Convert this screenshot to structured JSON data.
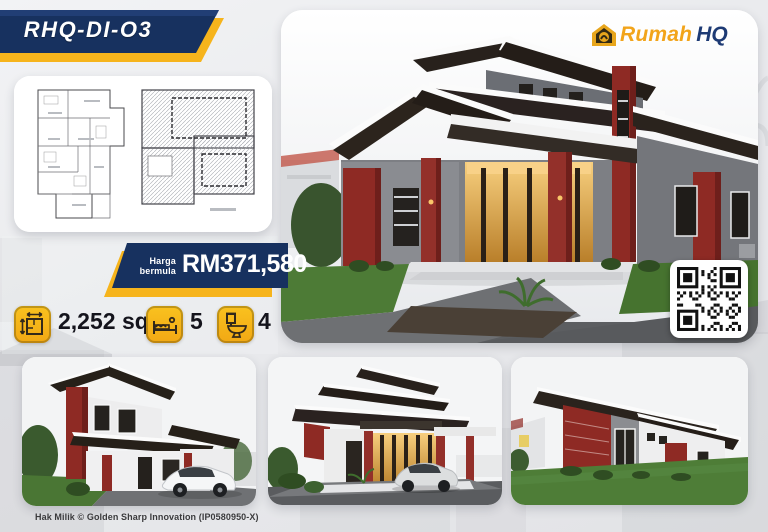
{
  "model_banner": {
    "label": "RHQ-DI-O3"
  },
  "logo": {
    "rumah": "Rumah",
    "hq": "HQ",
    "icon": "house-icon"
  },
  "price_banner": {
    "prefix_line1": "Harga",
    "prefix_line2": "bermula",
    "price": "RM371,580"
  },
  "specs": [
    {
      "icon": "floor-area-icon",
      "value": "2,252 sqf"
    },
    {
      "icon": "bed-icon",
      "value": "5"
    },
    {
      "icon": "toilet-icon",
      "value": "4"
    }
  ],
  "qr": {
    "label": "qr-code"
  },
  "footer": {
    "copyright": "Hak Milik © Golden Sharp Innovation (IP0580950-X)"
  },
  "colors": {
    "navy": "#17315f",
    "gold": "#f6b41c",
    "maroon": "#8e2a24",
    "roof": "#28211c",
    "lawn": "#4d7b36"
  }
}
